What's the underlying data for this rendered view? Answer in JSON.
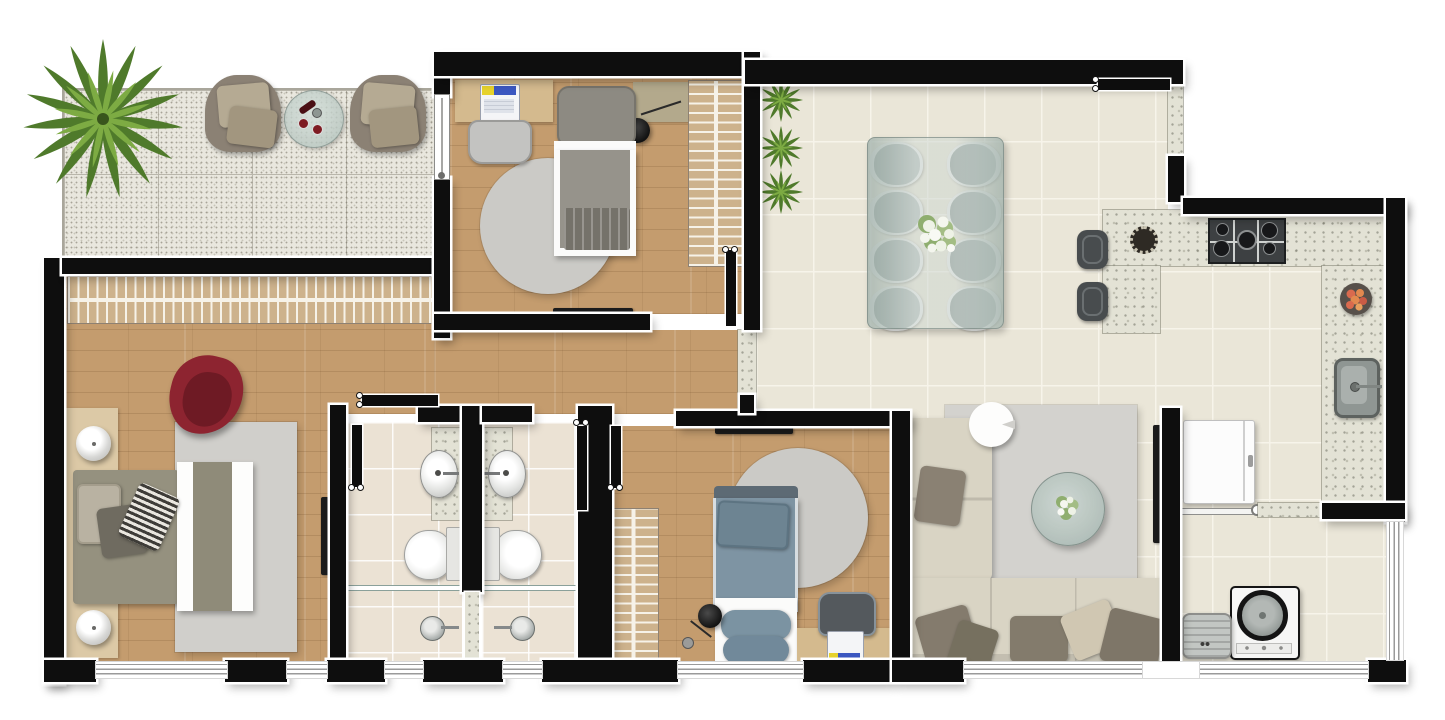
{
  "title": "apartment-floor-plan-top-view",
  "palette": {
    "wall": "#0e0e0e",
    "wallOutline": "#ffffff",
    "wood": "#c49c6e",
    "cream": "#eae6d8",
    "creamLine": "#f7f4ea",
    "bath": "#ebe2d4",
    "balc": "#e9e7de",
    "balcLine": "#b9b6ab",
    "rug": "#d0cfcb",
    "sofa": "#d9d4c4",
    "cushion": "#847c6e",
    "bedTaupe": "#95917f",
    "bedBlue": "#7e94a3",
    "redChair": "#8d2430",
    "slat": "#cdb28c",
    "steel": "#9aa09e",
    "glass": "#b8c4c0",
    "plantDark": "#4f7a2b",
    "plantLight": "#7dab43"
  },
  "rooms": {
    "balcony": {
      "items": [
        "palm-plant",
        "armchair",
        "armchair",
        "glass-side-table",
        "wine-bottle",
        "glasses"
      ]
    },
    "bedroom_1": {
      "items": [
        "desk",
        "laptop",
        "desk-chair",
        "single-bed",
        "reading-lamp",
        "bedside-shelf",
        "round-rug",
        "slatted-wardrobe",
        "wall-tv",
        "sliding-glass-door"
      ]
    },
    "dining_room": {
      "items": [
        "glass-dining-table",
        "dining-chair-x8",
        "flower-centerpiece",
        "plant",
        "plant",
        "plant"
      ]
    },
    "kitchen": {
      "items": [
        "u-shaped-granite-counter",
        "gas-cooktop-5-burner",
        "kitchen-sink",
        "fruit-bowl",
        "decor-plate",
        "bar-stool",
        "bar-stool",
        "entry-door"
      ]
    },
    "master_bedroom": {
      "items": [
        "double-bed",
        "headboard-panel",
        "bedside-lamp",
        "bedside-lamp",
        "slatted-wardrobe",
        "red-armchair",
        "area-rug",
        "wall-tv"
      ]
    },
    "bathroom_1": {
      "items": [
        "vanity-sink",
        "toilet",
        "glass-shower-partition",
        "shower-valve"
      ]
    },
    "bathroom_2": {
      "items": [
        "vanity-sink",
        "toilet",
        "glass-shower-partition",
        "shower-valve"
      ]
    },
    "bedroom_2": {
      "items": [
        "single-bed",
        "round-rug",
        "slatted-wardrobe",
        "desk",
        "laptop",
        "desk-chair",
        "floor-lamp",
        "wall-tv"
      ]
    },
    "living_room": {
      "items": [
        "l-shaped-sofa",
        "throw-pillows",
        "round-side-table",
        "glass-coffee-table",
        "flower-vase",
        "area-rug",
        "wall-tv"
      ]
    },
    "laundry_area": {
      "items": [
        "refrigerator",
        "towel-rail",
        "washing-machine",
        "laundry-basket",
        "granite-counter"
      ]
    }
  }
}
